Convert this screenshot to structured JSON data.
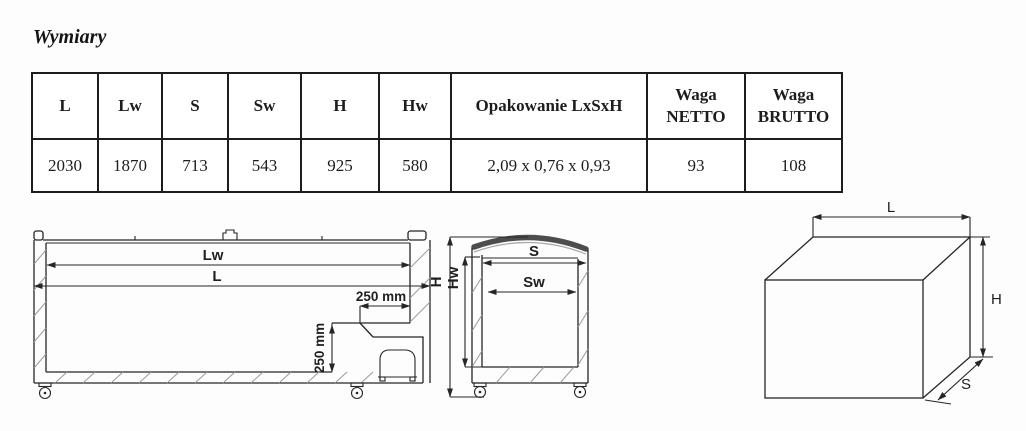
{
  "title": "Wymiary",
  "table": {
    "headers": [
      "L",
      "Lw",
      "S",
      "Sw",
      "H",
      "Hw",
      "Opakowanie LxSxH",
      "Waga NETTO",
      "Waga BRUTTO"
    ],
    "values": [
      "2030",
      "1870",
      "713",
      "543",
      "925",
      "580",
      "2,09 x 0,76 x 0,93",
      "93",
      "108"
    ]
  },
  "drawings": {
    "side": {
      "lw": "Lw",
      "l": "L",
      "d250h": "250 mm",
      "d250v": "250 mm"
    },
    "front": {
      "s": "S",
      "sw": "Sw",
      "h": "H",
      "hw": "Hw"
    },
    "box": {
      "l": "L",
      "h": "H",
      "s": "S"
    }
  },
  "colors": {
    "ink": "#262626",
    "table_border": "#1d1d1d",
    "lid_fill": "#4d4d4d",
    "hatch": "#9a9a9a",
    "background": "#fdfdfd"
  }
}
